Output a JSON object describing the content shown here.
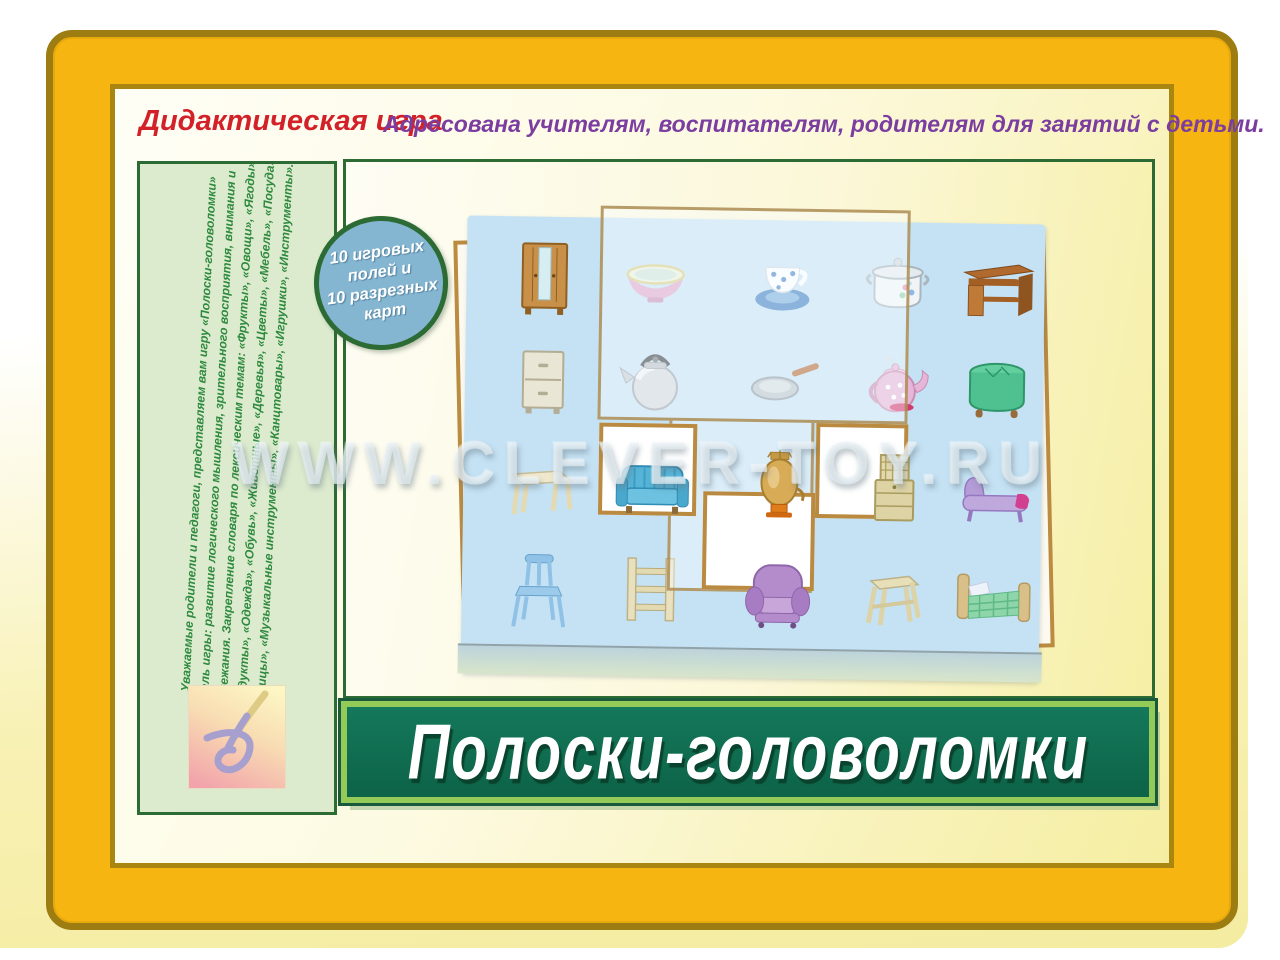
{
  "header": {
    "category": "Дидактическая игра",
    "audience": "Адресована учителям, воспитателям, родителям для занятий с детьми."
  },
  "sidebar": {
    "description_lines": [
      "Уважаемые родители и педагоги, представляем вам игру «Полоски-головоломки»",
      "Цель игры: развитие логического мышления, зрительного восприятия, внимания и",
      "прилежания. Закрепление словаря по лексическим темам: «Фрукты», «Овощи», «Ягоды»,",
      "«Продукты», «Одежда», «Обувь», «Животные», «Деревья», «Цветы», «Мебель», «Посуда»,",
      "«Птицы», «Музыкальные инструменты», «Канцтовары», «Игрушки», «Инструменты»."
    ]
  },
  "badge": {
    "line1": "10 игровых полей и",
    "line2": "10 разрезных карт"
  },
  "title_banner": {
    "title": "Полоски-головоломки"
  },
  "watermark": {
    "text": "WWW.CLEVER-TOY.RU"
  },
  "board": {
    "empty_slot_count": 3,
    "items": [
      {
        "icon": "wardrobe-icon",
        "key": "wardrobe",
        "row": 0,
        "col": 0
      },
      {
        "icon": "bowl-icon",
        "key": "bowl",
        "row": 0,
        "col": 1
      },
      {
        "icon": "cup-saucer-icon",
        "key": "cup",
        "row": 0,
        "col": 2
      },
      {
        "icon": "cooking-pot-icon",
        "key": "pot",
        "row": 0,
        "col": 3
      },
      {
        "icon": "desk-icon",
        "key": "desk",
        "row": 0,
        "col": 4
      },
      {
        "icon": "nightstand-icon",
        "key": "nightstand",
        "row": 1,
        "col": 0
      },
      {
        "icon": "kettle-icon",
        "key": "kettle",
        "row": 1,
        "col": 1
      },
      {
        "icon": "frying-pan-icon",
        "key": "pan",
        "row": 1,
        "col": 2
      },
      {
        "icon": "teapot-icon",
        "key": "teapot",
        "row": 1,
        "col": 3
      },
      {
        "icon": "ottoman-icon",
        "key": "ottoman",
        "row": 1,
        "col": 4
      },
      {
        "icon": "table-icon",
        "key": "table",
        "row": 2,
        "col": 0
      },
      {
        "icon": "sofa-icon",
        "key": "sofa",
        "row": 2,
        "col": 1
      },
      {
        "icon": "samovar-icon",
        "key": "samovar",
        "row": 2,
        "col": 2
      },
      {
        "icon": "cabinet-icon",
        "key": "cabinet",
        "row": 2,
        "col": 3
      },
      {
        "icon": "chaise-icon",
        "key": "chaise",
        "row": 2,
        "col": 4
      },
      {
        "icon": "chair-icon",
        "key": "chair",
        "row": 3,
        "col": 0
      },
      {
        "icon": "shelf-icon",
        "key": "shelf",
        "row": 3,
        "col": 1
      },
      {
        "icon": "armchair-icon",
        "key": "armchair",
        "row": 3,
        "col": 2
      },
      {
        "icon": "stool-icon",
        "key": "stool",
        "row": 3,
        "col": 3
      },
      {
        "icon": "bed-icon",
        "key": "bed",
        "row": 3,
        "col": 4
      }
    ]
  },
  "colors": {
    "frame_gold": "#f6b511",
    "frame_border": "#9d7d11",
    "banner_green": "#0d6347",
    "banner_light_green": "#93ca58",
    "board_blue": "#c5e2f4",
    "sidebar_green": "#dcebce",
    "dark_green_border": "#2d6b35",
    "badge_blue": "#84b6d2",
    "category_red": "#d22128",
    "audience_purple": "#7b3da0",
    "sidebar_text_green": "#2f8a3f",
    "tan_border": "#b98a3f"
  }
}
